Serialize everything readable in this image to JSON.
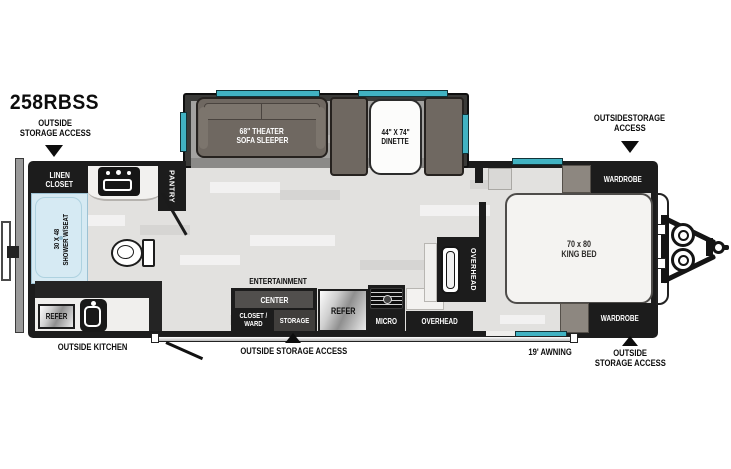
{
  "model_number": "258RBSS",
  "callouts": {
    "top_left_line1": "OUTSIDE",
    "top_left_line2": "STORAGE ACCESS",
    "top_right_line1": "OUTSIDESTORAGE",
    "top_right_line2": "ACCESS",
    "bottom_left": "OUTSIDE KITCHEN",
    "bottom_center": "OUTSIDE STORAGE ACCESS",
    "awning": "19' AWNING",
    "bottom_right_line1": "OUTSIDE",
    "bottom_right_line2": "STORAGE ACCESS"
  },
  "rooms": {
    "linen_line1": "LINEN",
    "linen_line2": "CLOSET",
    "pantry": "PANTRY",
    "shower_line1": "30 X 48",
    "shower_line2": "SHOWER W/SEAT",
    "outside_refer": "REFER",
    "sofa_line1": "68\" THEATER",
    "sofa_line2": "SOFA SLEEPER",
    "dinette_line1": "44\" X 74\"",
    "dinette_line2": "DINETTE",
    "ent_line1": "ENTERTAINMENT",
    "ent_line2": "CENTER",
    "closet_line1": "CLOSET /",
    "closet_line2": "WARD",
    "storage": "STORAGE",
    "refer": "REFER",
    "micro": "MICRO",
    "overhead_galley": "OVERHEAD",
    "overhead_tall": "OVERHEAD",
    "bed_line1": "70 x 80",
    "bed_line2": "KING BED",
    "wardrobe_front_top": "WARDROBE",
    "wardrobe_front_bottom": "WARDROBE"
  },
  "colors": {
    "window_accent": "#41b2c2",
    "wall": "#1c1c1c",
    "floor": "#e2e1df",
    "slide_floor": "#a3a2a0",
    "furniture_taupe": "#6f6861",
    "shower_blue": "#d6eaf3"
  }
}
